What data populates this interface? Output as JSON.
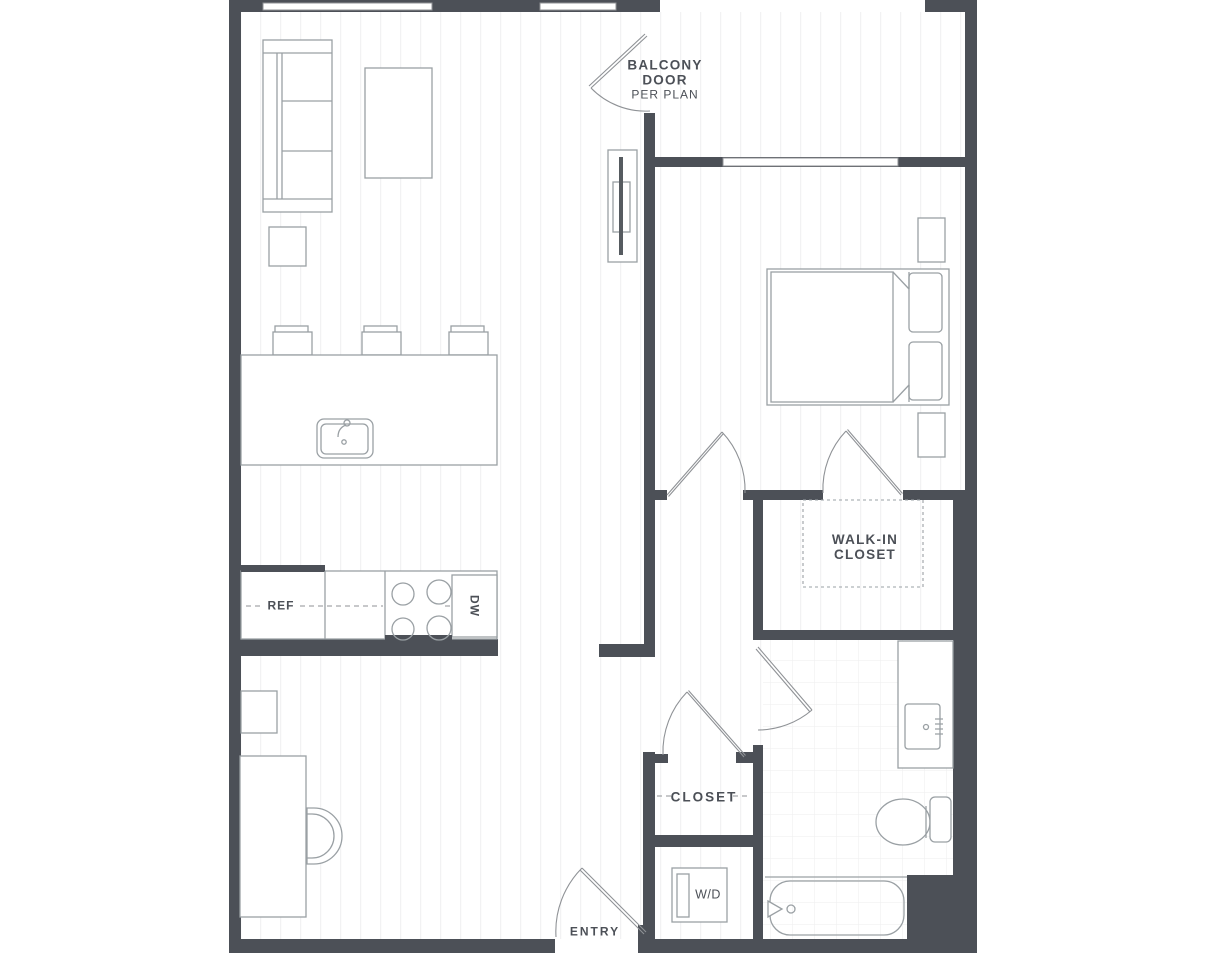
{
  "colors": {
    "wall": "#4c5057",
    "line": "#8f9296",
    "furniture": "#9aa0a4",
    "text": "#4c5057",
    "stripe": "#f2f2f3",
    "tile": "#f0f0f1"
  },
  "labels": {
    "balcony_door": {
      "line1": "BALCONY",
      "line2": "DOOR",
      "line3": "PER PLAN"
    },
    "walk_in_closet": {
      "line1": "WALK-IN",
      "line2": "CLOSET"
    },
    "closet": "CLOSET",
    "entry": "ENTRY",
    "washer_dryer": "W/D",
    "refrigerator": "REF",
    "dishwasher": "DW"
  }
}
